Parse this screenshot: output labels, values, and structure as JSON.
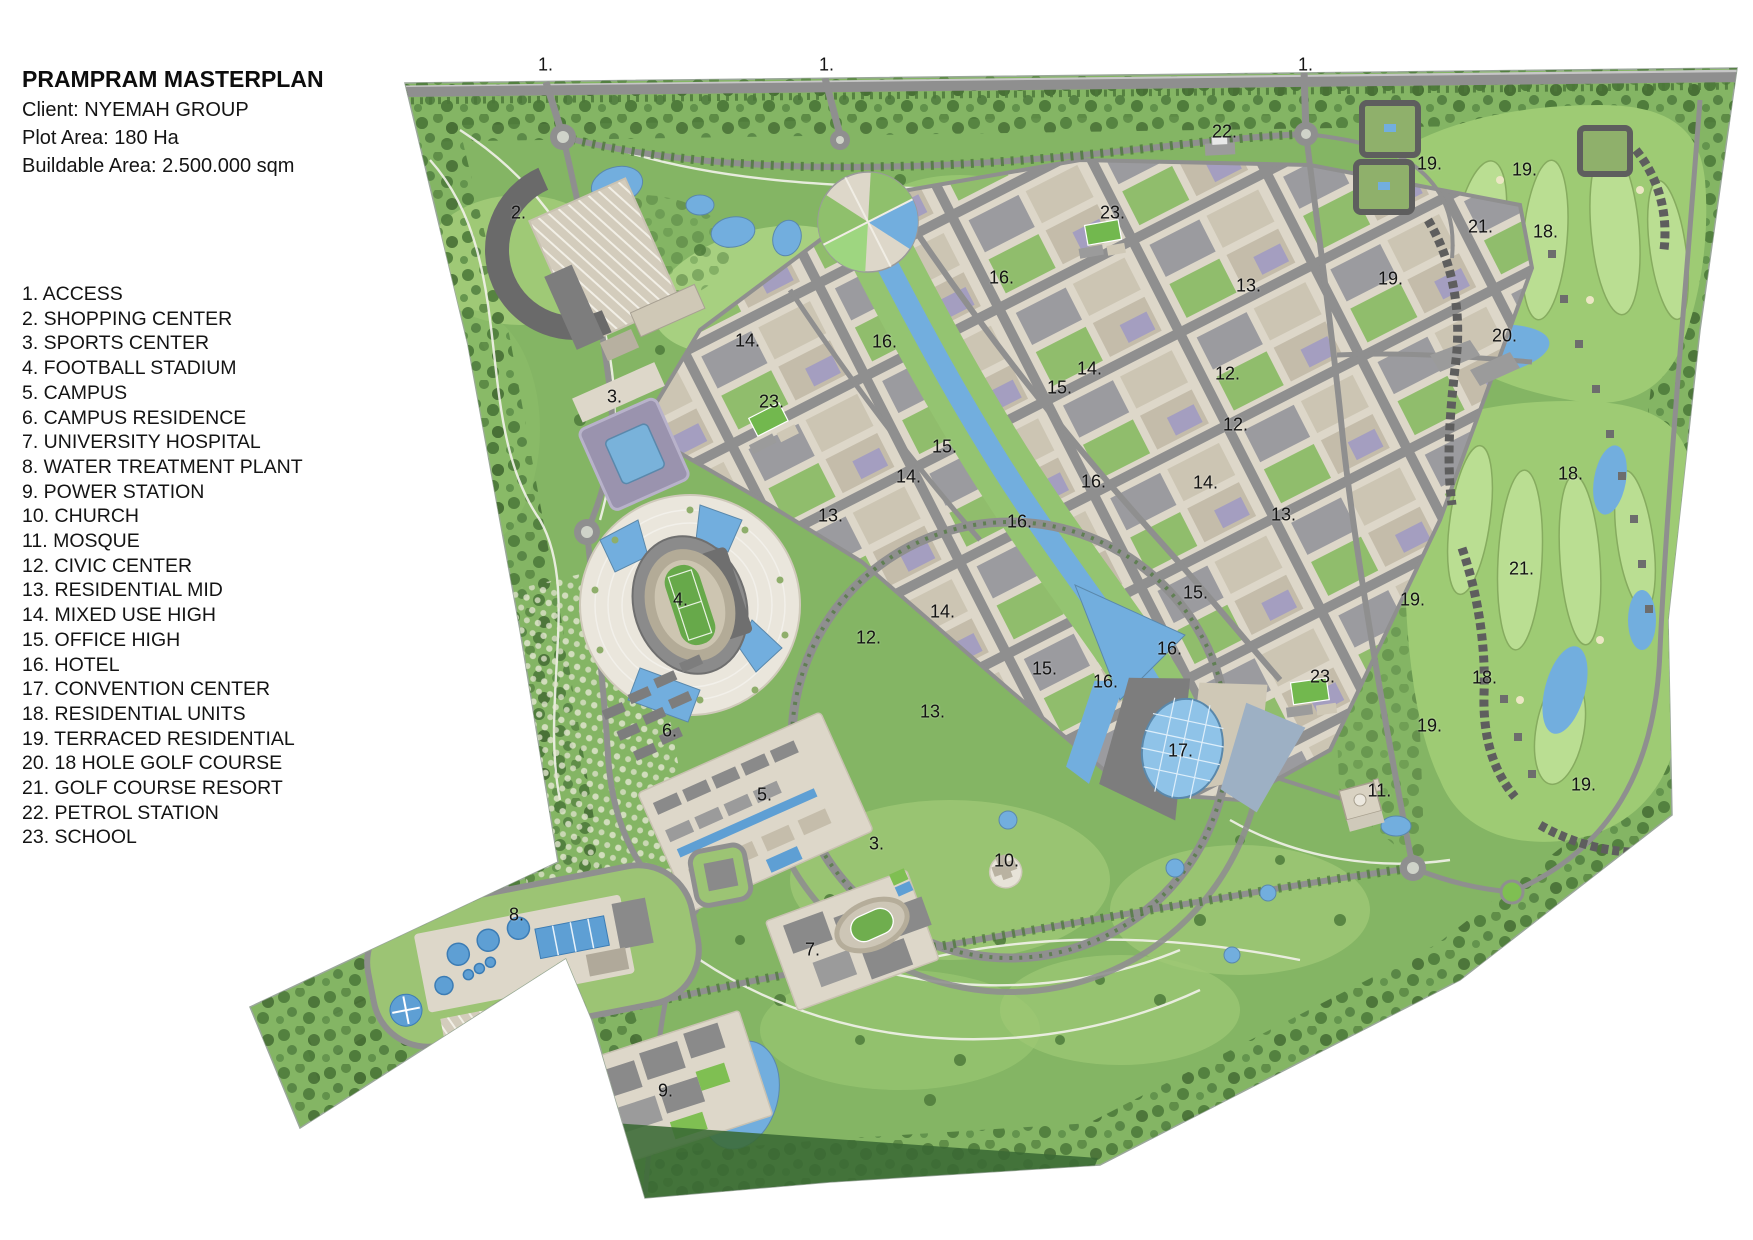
{
  "header": {
    "title": "PRAMPRAM MASTERPLAN",
    "lines": [
      "Client: NYEMAH GROUP",
      "Plot Area: 180 Ha",
      "Buildable Area: 2.500.000 sqm"
    ]
  },
  "legend": {
    "items": [
      "1. ACCESS",
      "2. SHOPPING CENTER",
      "3. SPORTS CENTER",
      "4. FOOTBALL STADIUM",
      "5. CAMPUS",
      "6. CAMPUS RESIDENCE",
      "7. UNIVERSITY HOSPITAL",
      "8. WATER TREATMENT PLANT",
      "9. POWER STATION",
      "10. CHURCH",
      "11. MOSQUE",
      "12. CIVIC CENTER",
      "13. RESIDENTIAL MID",
      "14. MIXED USE HIGH",
      "15. OFFICE HIGH",
      "16. HOTEL",
      "17. CONVENTION CENTER",
      "18. RESIDENTIAL UNITS",
      "19. TERRACED RESIDENTIAL",
      "20. 18 HOLE GOLF COURSE",
      "21. GOLF COURSE RESORT",
      "22. PETROL STATION",
      "23. SCHOOL"
    ]
  },
  "map": {
    "colors": {
      "site_green": "#84b564",
      "park_green": "#a8d07c",
      "forest_green": "#4e7b3b",
      "golf_green": "#b7dc8f",
      "water_blue": "#72aede",
      "road_gray": "#8f8f8f",
      "urban_base": "#ddd7c9",
      "block_gray": "#9b9b9f",
      "block_lavender": "#a49ec0",
      "pitch_green": "#67a94a",
      "dark_edge": "#3a6a34"
    },
    "labels": [
      {
        "t": "1.",
        "x": 544,
        "y": 66
      },
      {
        "t": "1.",
        "x": 825,
        "y": 66
      },
      {
        "t": "1.",
        "x": 1304,
        "y": 66
      },
      {
        "t": "2.",
        "x": 517,
        "y": 214
      },
      {
        "t": "3.",
        "x": 613,
        "y": 398
      },
      {
        "t": "3.",
        "x": 875,
        "y": 845
      },
      {
        "t": "4.",
        "x": 679,
        "y": 601
      },
      {
        "t": "5.",
        "x": 763,
        "y": 796
      },
      {
        "t": "6.",
        "x": 668,
        "y": 732
      },
      {
        "t": "7.",
        "x": 811,
        "y": 951
      },
      {
        "t": "8.",
        "x": 515,
        "y": 916
      },
      {
        "t": "9.",
        "x": 664,
        "y": 1092
      },
      {
        "t": "10.",
        "x": 1004,
        "y": 862
      },
      {
        "t": "11.",
        "x": 1377,
        "y": 792
      },
      {
        "t": "12.",
        "x": 866,
        "y": 639
      },
      {
        "t": "12.",
        "x": 1225,
        "y": 375
      },
      {
        "t": "12.",
        "x": 1233,
        "y": 426
      },
      {
        "t": "13.",
        "x": 828,
        "y": 517
      },
      {
        "t": "13.",
        "x": 930,
        "y": 713
      },
      {
        "t": "13.",
        "x": 1246,
        "y": 287
      },
      {
        "t": "13.",
        "x": 1281,
        "y": 516
      },
      {
        "t": "14.",
        "x": 745,
        "y": 342
      },
      {
        "t": "14.",
        "x": 906,
        "y": 478
      },
      {
        "t": "14.",
        "x": 940,
        "y": 613
      },
      {
        "t": "14.",
        "x": 1087,
        "y": 370
      },
      {
        "t": "14.",
        "x": 1203,
        "y": 484
      },
      {
        "t": "15.",
        "x": 942,
        "y": 448
      },
      {
        "t": "15.",
        "x": 1057,
        "y": 389
      },
      {
        "t": "15.",
        "x": 1042,
        "y": 670
      },
      {
        "t": "15.",
        "x": 1193,
        "y": 594
      },
      {
        "t": "16.",
        "x": 882,
        "y": 343
      },
      {
        "t": "16.",
        "x": 999,
        "y": 279
      },
      {
        "t": "16.",
        "x": 1017,
        "y": 523
      },
      {
        "t": "16.",
        "x": 1091,
        "y": 483
      },
      {
        "t": "16.",
        "x": 1103,
        "y": 683
      },
      {
        "t": "16.",
        "x": 1167,
        "y": 650
      },
      {
        "t": "17.",
        "x": 1178,
        "y": 752
      },
      {
        "t": "18.",
        "x": 1543,
        "y": 233
      },
      {
        "t": "18.",
        "x": 1568,
        "y": 475
      },
      {
        "t": "18.",
        "x": 1482,
        "y": 679
      },
      {
        "t": "19.",
        "x": 1427,
        "y": 165
      },
      {
        "t": "19.",
        "x": 1522,
        "y": 171
      },
      {
        "t": "19.",
        "x": 1388,
        "y": 280
      },
      {
        "t": "19.",
        "x": 1410,
        "y": 601
      },
      {
        "t": "19.",
        "x": 1427,
        "y": 727
      },
      {
        "t": "19.",
        "x": 1581,
        "y": 786
      },
      {
        "t": "20.",
        "x": 1502,
        "y": 337
      },
      {
        "t": "21.",
        "x": 1478,
        "y": 228
      },
      {
        "t": "21.",
        "x": 1519,
        "y": 570
      },
      {
        "t": "22.",
        "x": 1222,
        "y": 133
      },
      {
        "t": "23.",
        "x": 1110,
        "y": 214
      },
      {
        "t": "23.",
        "x": 769,
        "y": 403
      },
      {
        "t": "23.",
        "x": 1320,
        "y": 678
      }
    ]
  }
}
